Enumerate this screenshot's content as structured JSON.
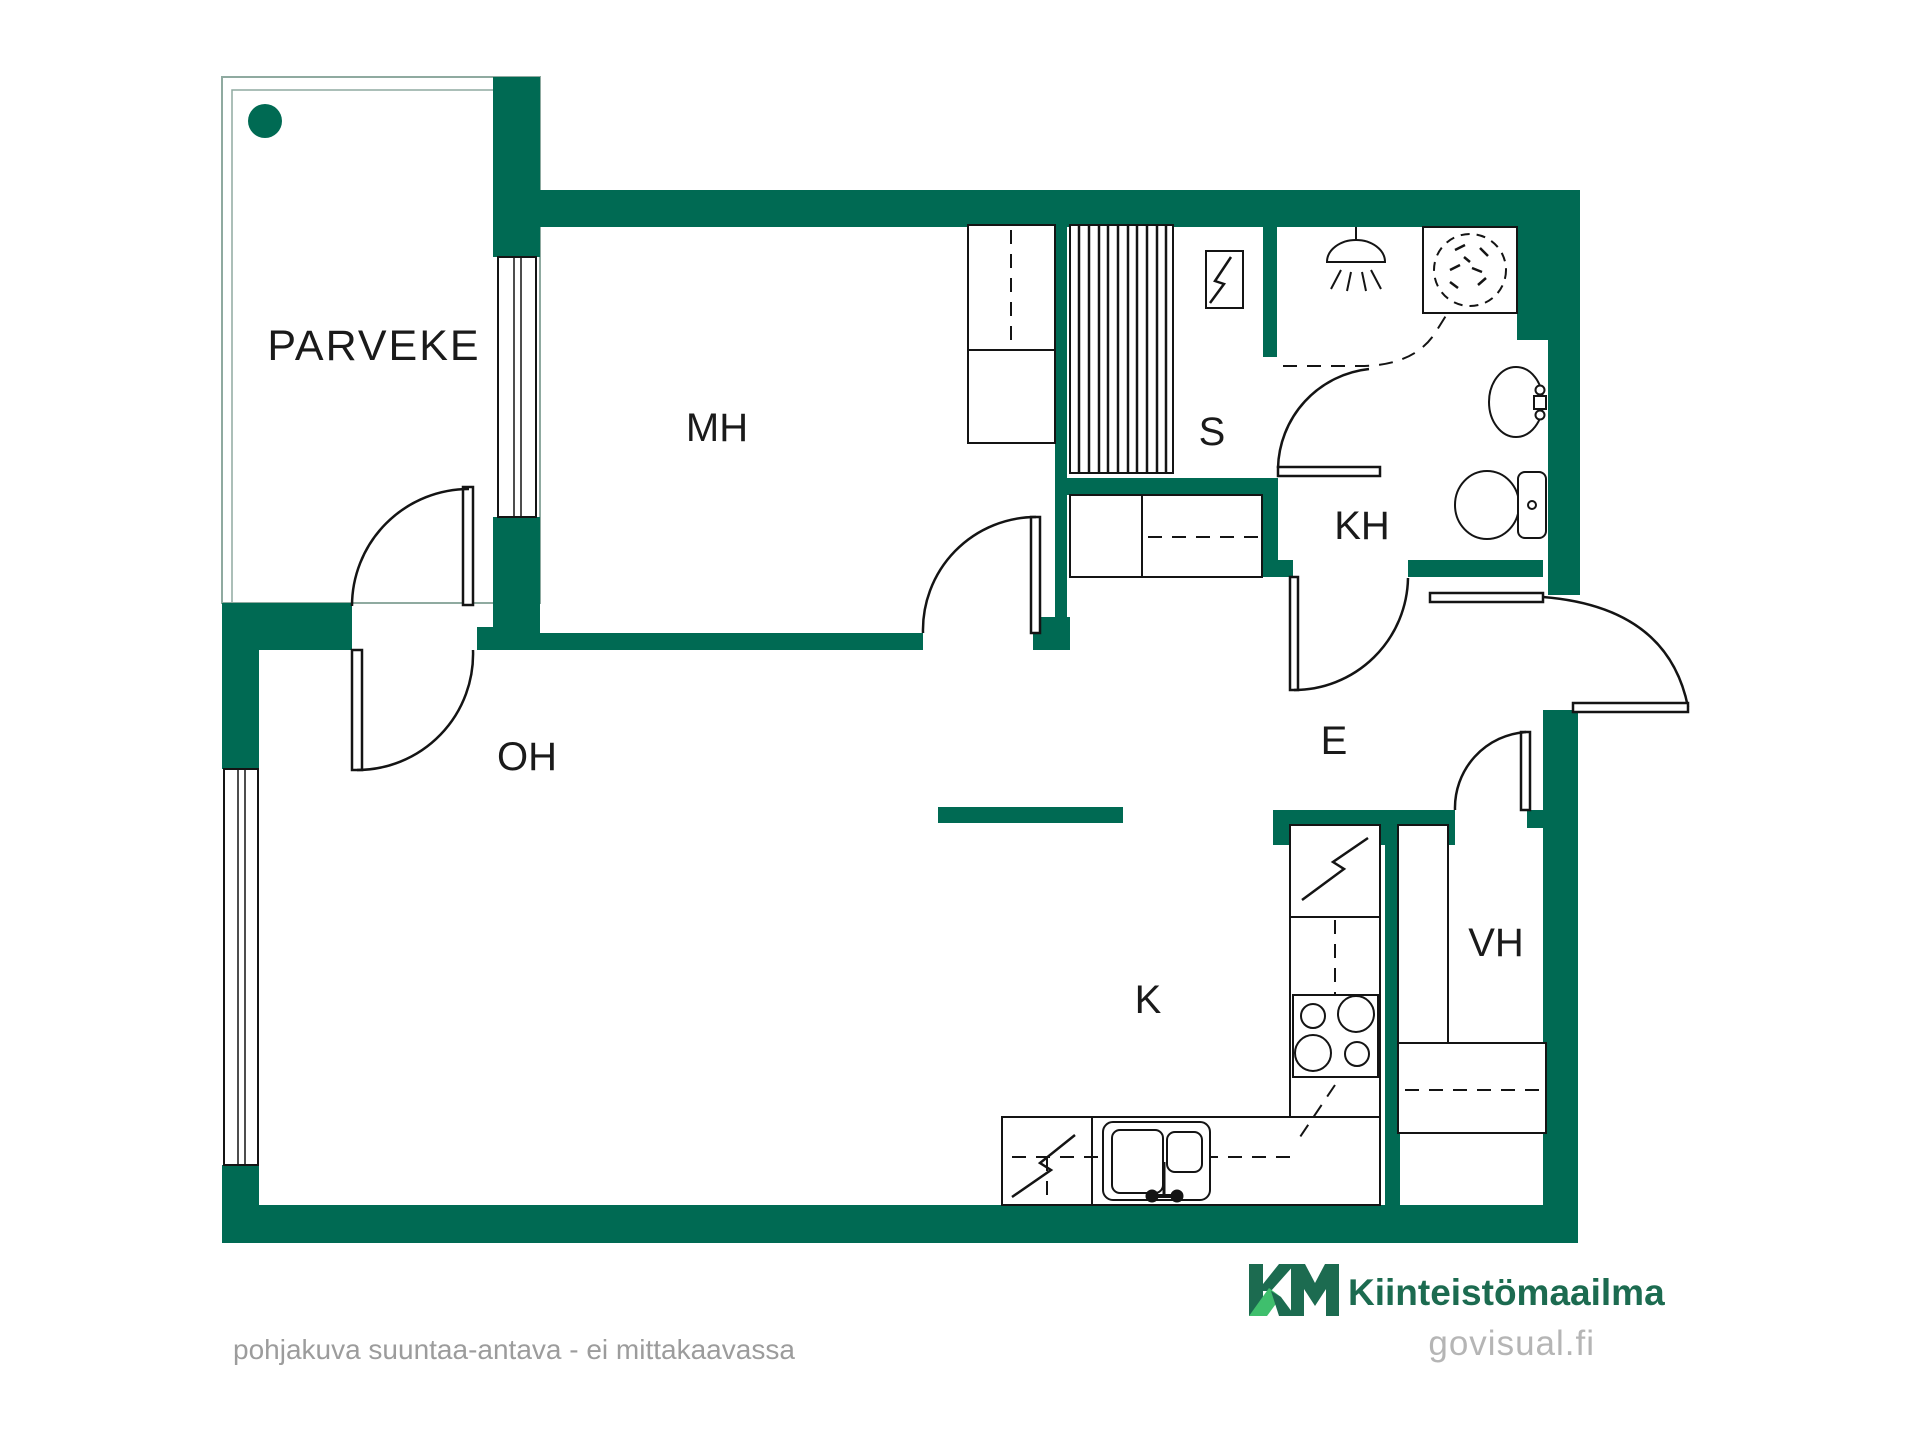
{
  "plan": {
    "title": "apartment floor plan",
    "rooms": [
      {
        "id": "parveke",
        "label": "PARVEKE"
      },
      {
        "id": "mh",
        "label": "MH"
      },
      {
        "id": "s",
        "label": "S"
      },
      {
        "id": "kh",
        "label": "KH"
      },
      {
        "id": "e",
        "label": "E"
      },
      {
        "id": "oh",
        "label": "OH"
      },
      {
        "id": "k",
        "label": "K"
      },
      {
        "id": "vh",
        "label": "VH"
      }
    ],
    "symbols": [
      "balcony-railing",
      "balcony-corner-dot",
      "balcony-double-door",
      "window",
      "interior-door",
      "entrance-door",
      "sauna-bench-hatch",
      "sauna-stove",
      "wardrobe-closet",
      "shower-head",
      "shower-curtain-dashed",
      "washing-machine",
      "washbasin",
      "toilet",
      "bathroom-cabinet",
      "kitchen-counter",
      "refrigerator-bolt",
      "cooktop-4-burners",
      "kitchen-sink-double",
      "dishwasher-bolt",
      "vh-wardrobe",
      "vh-shelf"
    ],
    "colors": {
      "wall_green": "#006A53",
      "line_black": "#141414",
      "balcony_outline": "#8FAAA0",
      "footer_gray": "#9C9C9C",
      "logo_dark_green": "#1C6B50",
      "logo_light_green": "#3FBF6D",
      "watermark_gray": "#B5B5B5"
    }
  },
  "footer": {
    "disclaimer": "pohjakuva suuntaa-antava - ei mittakaavassa",
    "brand_mark": "KM",
    "brand": "Kiinteistömaailma",
    "watermark": "govisual.fi"
  }
}
